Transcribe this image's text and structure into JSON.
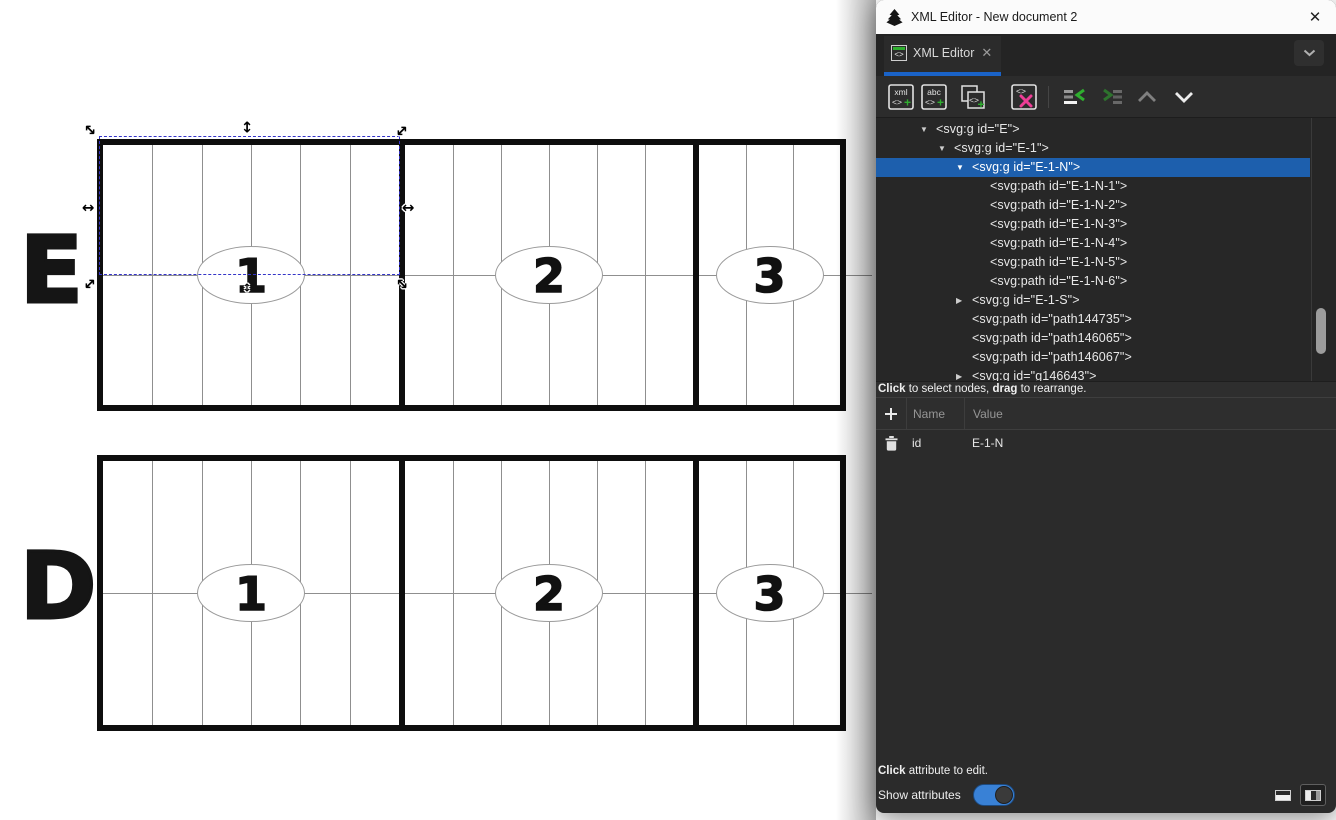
{
  "window": {
    "title": "XML Editor - New document 2"
  },
  "tabs": {
    "active": {
      "label": "XML Editor",
      "icon": "xml-editor-tab-icon",
      "close_icon": "tab-close-icon"
    }
  },
  "toolbar": {
    "icons": [
      "new-element-node-icon",
      "new-text-node-icon",
      "duplicate-node-icon",
      "delete-node-icon",
      "unindent-node-icon",
      "indent-node-icon",
      "move-node-up-icon",
      "move-node-down-icon"
    ]
  },
  "tree": {
    "rows": [
      {
        "text": "<svg:g id=\"E\">",
        "level": 1,
        "state": "expanded",
        "selected": false
      },
      {
        "text": "<svg:g id=\"E-1\">",
        "level": 2,
        "state": "expanded",
        "selected": false
      },
      {
        "text": "<svg:g id=\"E-1-N\">",
        "level": 3,
        "state": "expanded",
        "selected": true
      },
      {
        "text": "<svg:path id=\"E-1-N-1\">",
        "level": 4,
        "state": "leaf",
        "selected": false
      },
      {
        "text": "<svg:path id=\"E-1-N-2\">",
        "level": 4,
        "state": "leaf",
        "selected": false
      },
      {
        "text": "<svg:path id=\"E-1-N-3\">",
        "level": 4,
        "state": "leaf",
        "selected": false
      },
      {
        "text": "<svg:path id=\"E-1-N-4\">",
        "level": 4,
        "state": "leaf",
        "selected": false
      },
      {
        "text": "<svg:path id=\"E-1-N-5\">",
        "level": 4,
        "state": "leaf",
        "selected": false
      },
      {
        "text": "<svg:path id=\"E-1-N-6\">",
        "level": 4,
        "state": "leaf",
        "selected": false
      },
      {
        "text": "<svg:g id=\"E-1-S\">",
        "level": 3,
        "state": "collapsed",
        "selected": false
      },
      {
        "text": "<svg:path id=\"path144735\">",
        "level": 3,
        "state": "leaf",
        "selected": false
      },
      {
        "text": "<svg:path id=\"path146065\">",
        "level": 3,
        "state": "leaf",
        "selected": false
      },
      {
        "text": "<svg:path id=\"path146067\">",
        "level": 3,
        "state": "leaf",
        "selected": false
      },
      {
        "text": "<svg:g id=\"g146643\">",
        "level": 3,
        "state": "collapsed",
        "selected": false
      }
    ],
    "hint": [
      {
        "t": "Click",
        "b": true
      },
      {
        "t": " to select nodes, ",
        "b": false
      },
      {
        "t": "drag",
        "b": true
      },
      {
        "t": " to rearrange.",
        "b": false
      }
    ]
  },
  "attributes": {
    "headers": {
      "name": "Name",
      "value": "Value"
    },
    "rows": [
      {
        "name": "id",
        "value": "E-1-N"
      }
    ],
    "hint": [
      {
        "t": "Click",
        "b": true
      },
      {
        "t": " attribute to edit.",
        "b": false
      }
    ]
  },
  "footer": {
    "show_attributes_label": "Show attributes",
    "toggle_on": true
  },
  "canvas": {
    "rows": [
      {
        "label": "E",
        "sections": [
          "1",
          "2",
          "3"
        ]
      },
      {
        "label": "D",
        "sections": [
          "1",
          "2",
          "3"
        ]
      }
    ],
    "selection": {
      "row": "E",
      "section": "1",
      "half": "north"
    }
  },
  "colors": {
    "selected_row_blue": "#1d5fad",
    "tab_underline_blue": "#1a63c8",
    "toggle_blue": "#3981d6",
    "icon_green": "#2fae2f",
    "icon_pink": "#ee3d96",
    "selection_dash_blue": "#3434c8"
  }
}
